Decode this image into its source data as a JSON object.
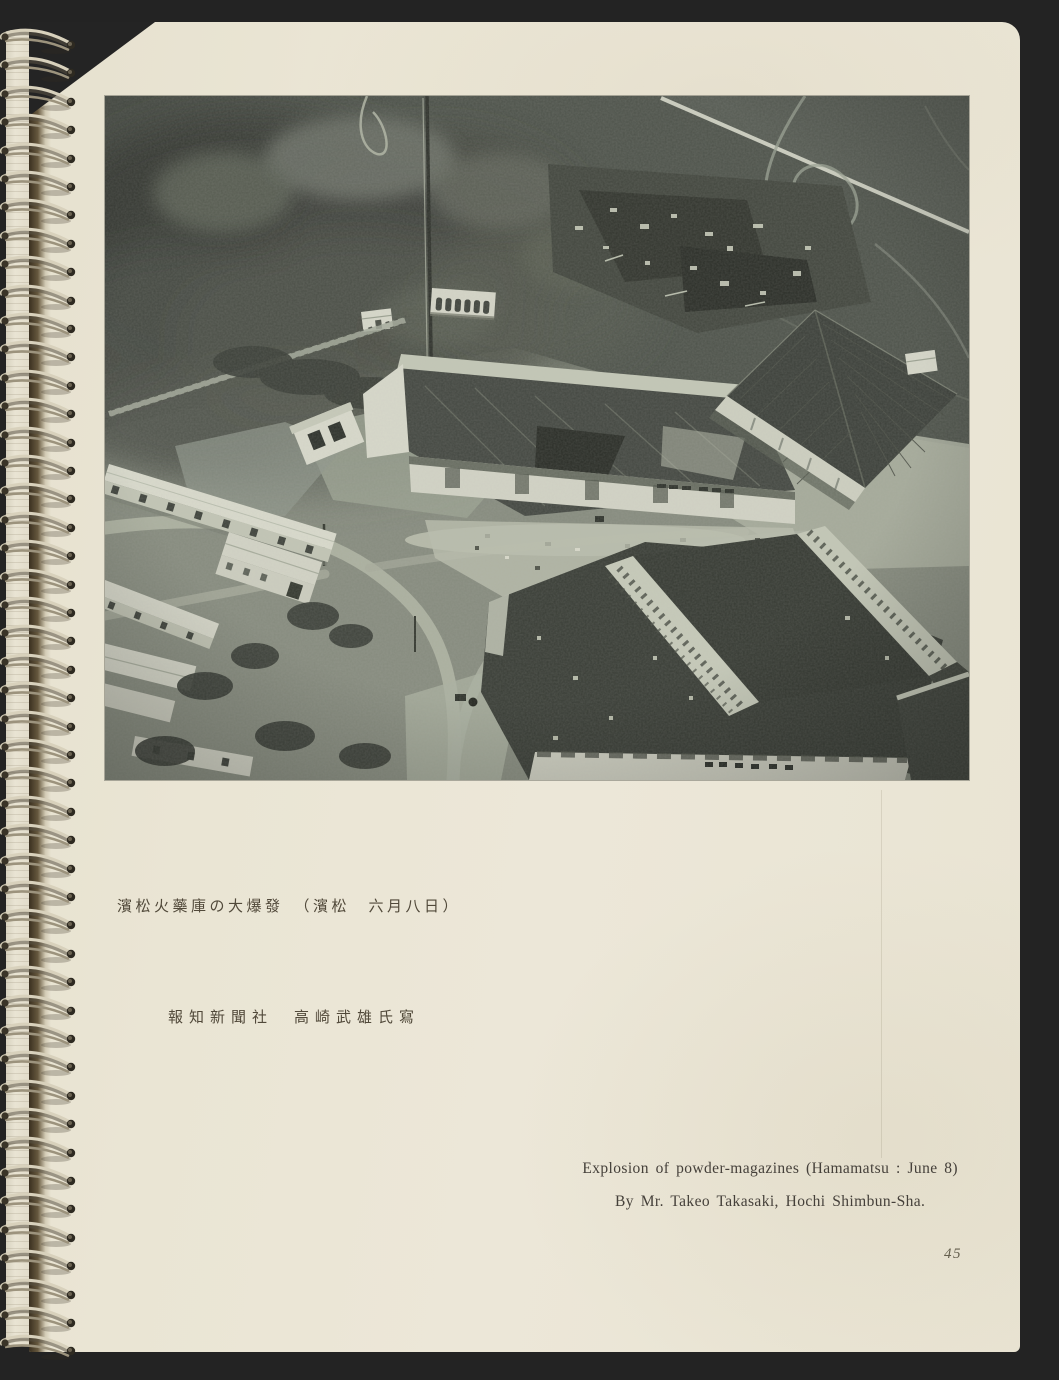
{
  "book_page": {
    "page_number": "45",
    "photo_caption_ja": {
      "line1": "濱松火藥庫の大爆發　（濱松　六月八日）",
      "line2": "報知新聞社　高崎武雄氏寫"
    },
    "photo_caption_en": {
      "line1": "Explosion of powder-magazines (Hamamatsu : June 8)",
      "line2": "By Mr. Takeo Takasaki, Hochi Shimbun-Sha."
    },
    "photo": {
      "description": "Aerial halftone photograph of the great explosion of the Hamamatsu powder magazines: dense dark smoke billowing at the upper left, a tall mast, fields crossed by light roads at the upper right, long white barracks and dirt roads at the lower left, and large storehouses with shattered dark roofs and pale debris-strewn ridges in the centre and foreground."
    }
  },
  "binding": {
    "style": "spiral-wire",
    "ring_count": 47
  },
  "colors": {
    "backdrop": "#232323",
    "paper": "#eae5d4",
    "caption_ink": "#4c473c",
    "photo_dark": "#3a3e37",
    "photo_light": "#d8d9cb",
    "ring_metal": "#d8d1bc"
  }
}
